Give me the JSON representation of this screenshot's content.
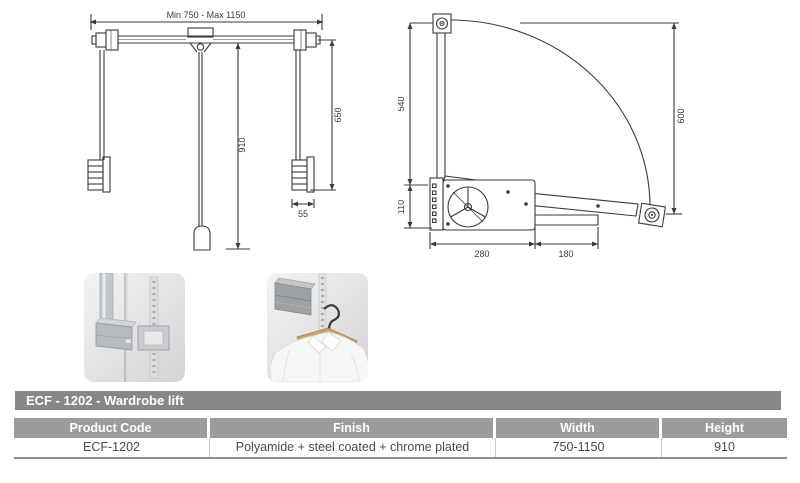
{
  "title_bar": {
    "text": "ECF - 1202 - Wardrobe lift"
  },
  "front_view": {
    "width_range": "Min 750 - Max 1150",
    "center_drop": "910",
    "side_drop": "650",
    "stop_width": "55"
  },
  "side_view": {
    "arm_upper": "540",
    "arm_lower": "110",
    "swing_height": "600",
    "body_depth": "280",
    "rail_depth": "180"
  },
  "table": {
    "columns": [
      "Product Code",
      "Finish",
      "Width",
      "Height"
    ],
    "row": [
      "ECF-1202",
      "Polyamide + steel coated + chrome plated",
      "750-1150",
      "910"
    ]
  },
  "colors": {
    "line": "#3a3a3a",
    "title_bar_bg": "#878787",
    "table_header_bg": "#9c9c9c"
  }
}
